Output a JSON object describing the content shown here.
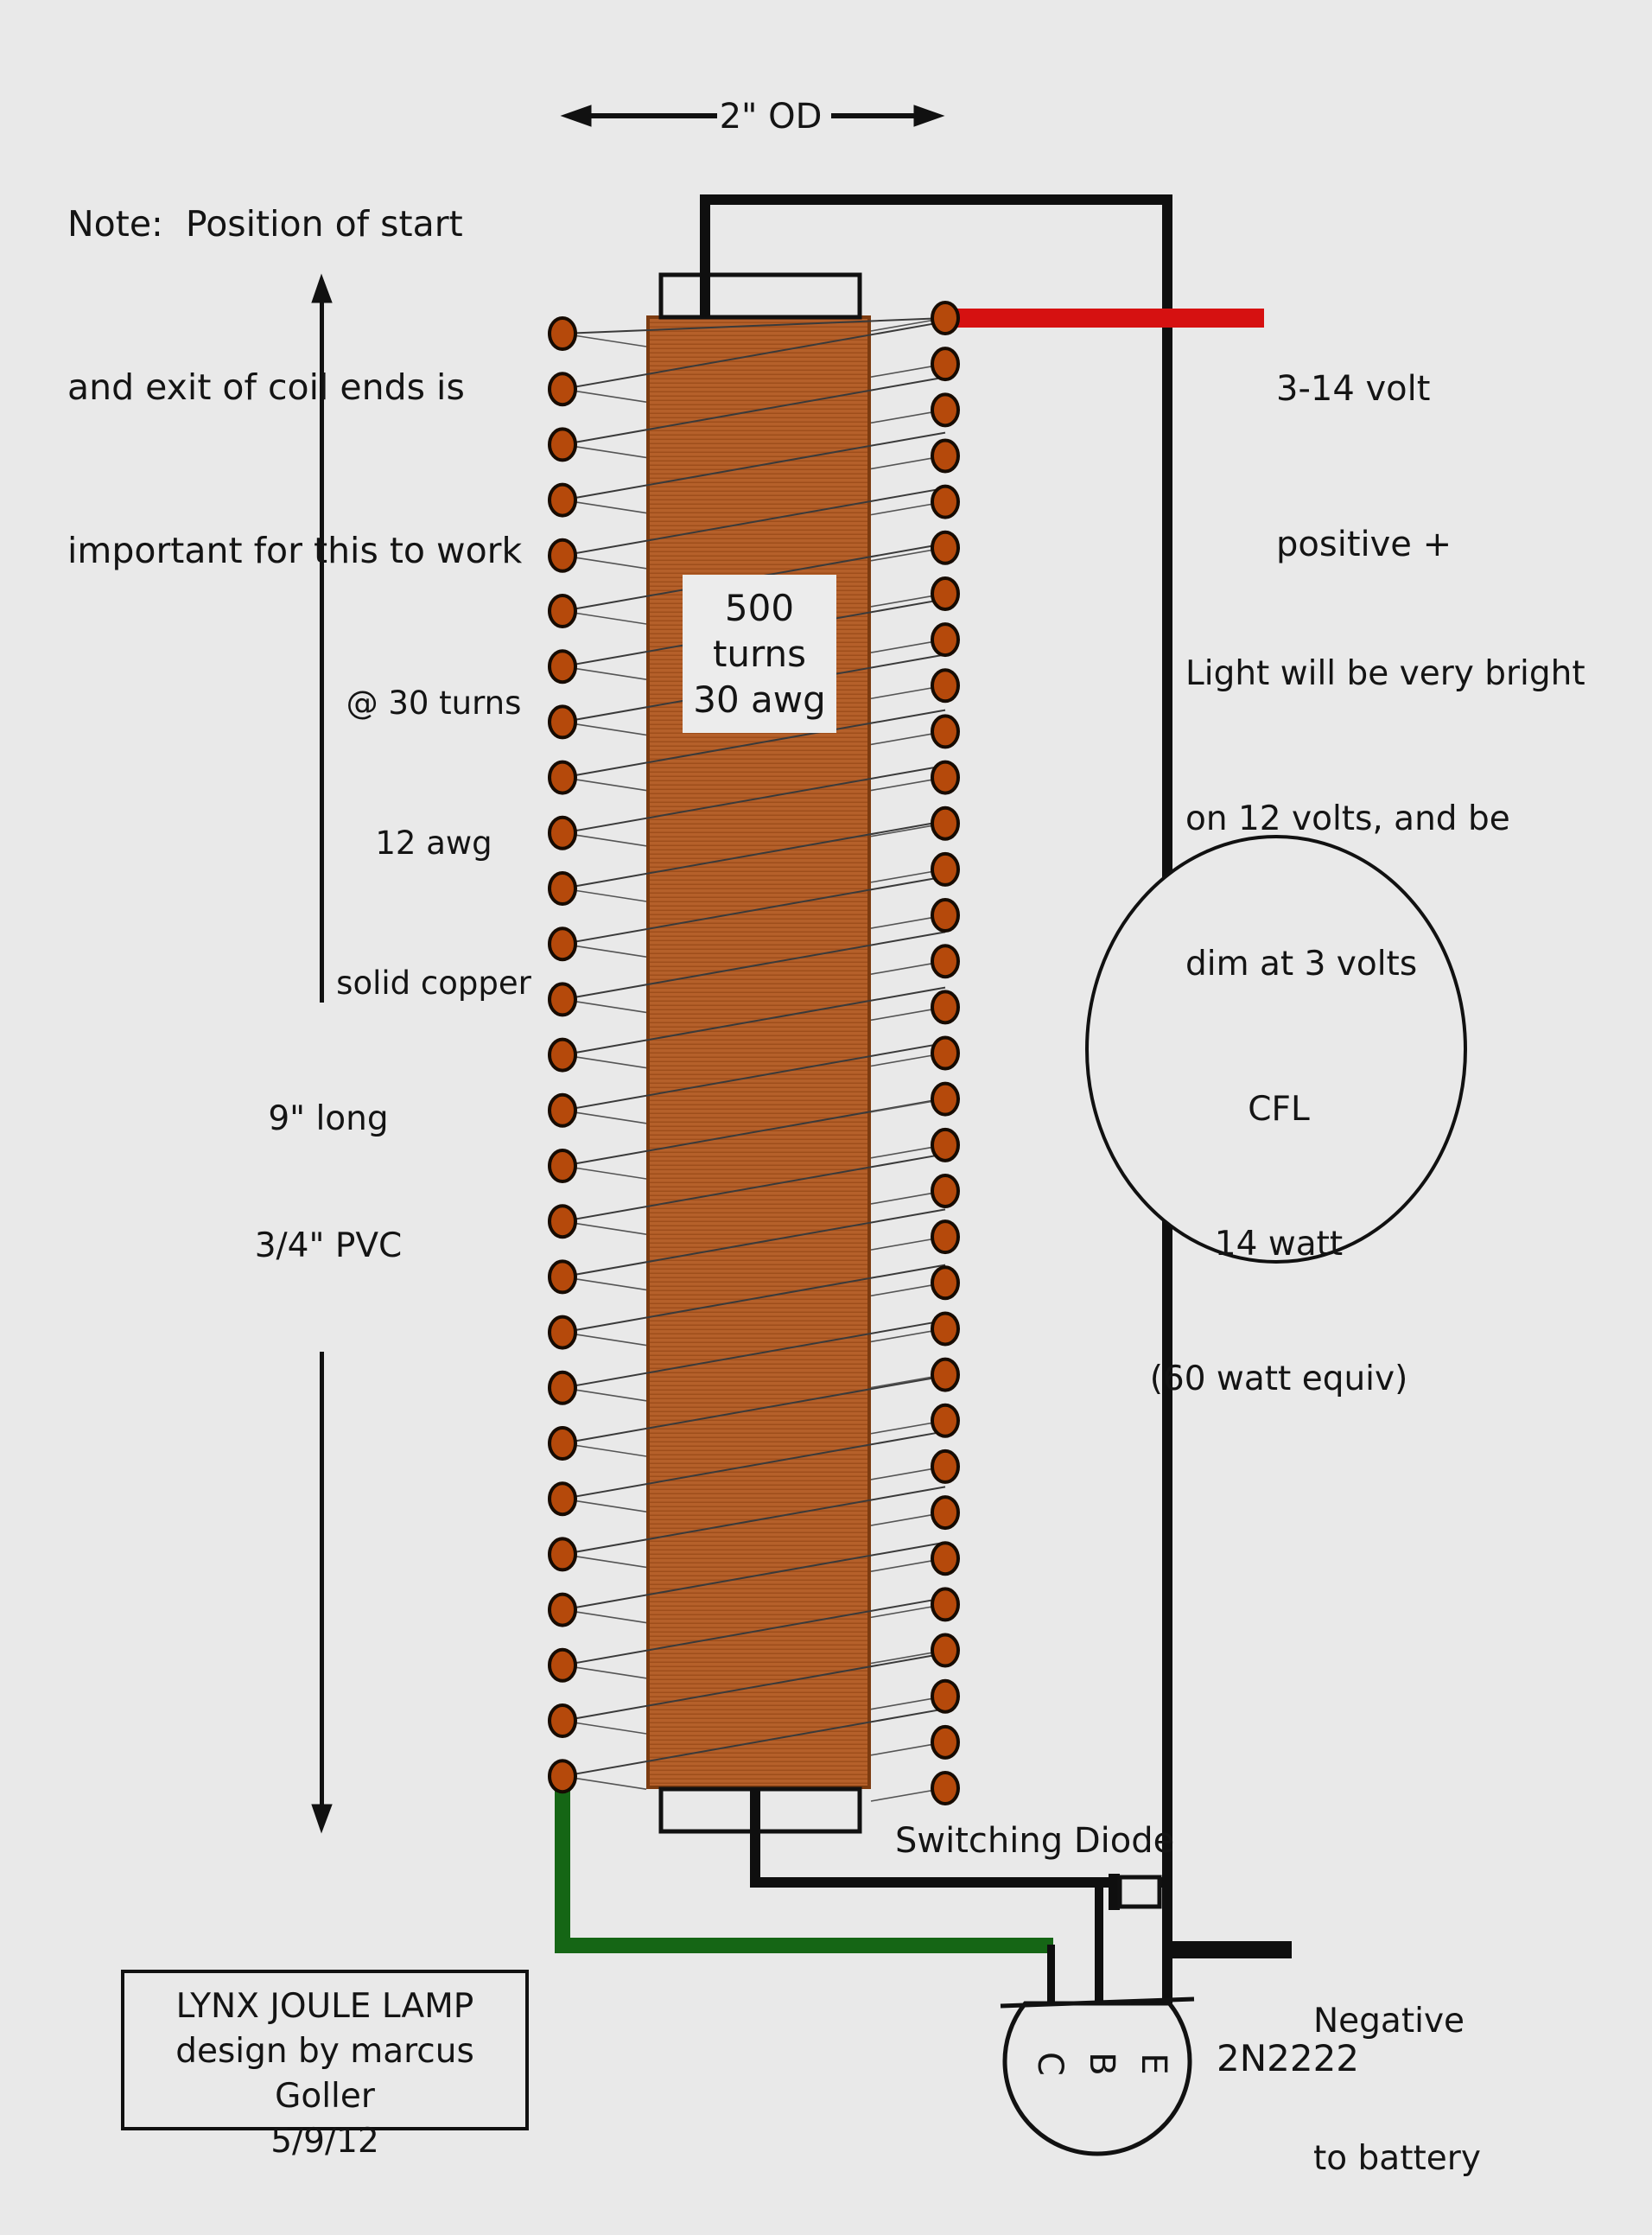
{
  "colors": {
    "background": "#e9e9e9",
    "wire_black": "#0f0f0f",
    "wire_red": "#d61111",
    "wire_green": "#156615",
    "coil_fill": "#b5602a",
    "coil_stripe": "#9e4e1b",
    "coil_border": "#7c3b10",
    "dot_fill": "#b5490b",
    "dot_border": "#160b02"
  },
  "note": {
    "lines": [
      "Note:  Position of start",
      "and exit of coil ends is",
      "important for this to work"
    ]
  },
  "dimensions": {
    "outer_diameter": "2\" OD",
    "pvc_lines": [
      "9\" long",
      "3/4\" PVC"
    ]
  },
  "positive_lead": {
    "lines": [
      "3-14 volt",
      "positive +"
    ]
  },
  "primary_coil": {
    "lines": [
      "@ 30 turns",
      "12 awg",
      "solid copper"
    ]
  },
  "secondary_coil": {
    "lines": [
      "500",
      "turns",
      "30 awg"
    ]
  },
  "brightness_note": {
    "lines": [
      "Light will be very bright",
      "on 12 volts, and be",
      "dim at 3 volts"
    ]
  },
  "cfl": {
    "lines": [
      "CFL",
      "14 watt",
      "(60 watt equiv)"
    ]
  },
  "diode": {
    "label": "Switching Diode"
  },
  "negative_lead": {
    "lines": [
      "Negative",
      "to battery"
    ]
  },
  "transistor": {
    "part_number": "2N2222",
    "pins": [
      "C",
      "B",
      "E"
    ]
  },
  "title_box": {
    "lines": [
      "LYNX JOULE LAMP",
      "design by marcus Goller",
      "5/9/12"
    ]
  },
  "coil_drawing": {
    "left_loops": 27,
    "right_loops": 33
  }
}
